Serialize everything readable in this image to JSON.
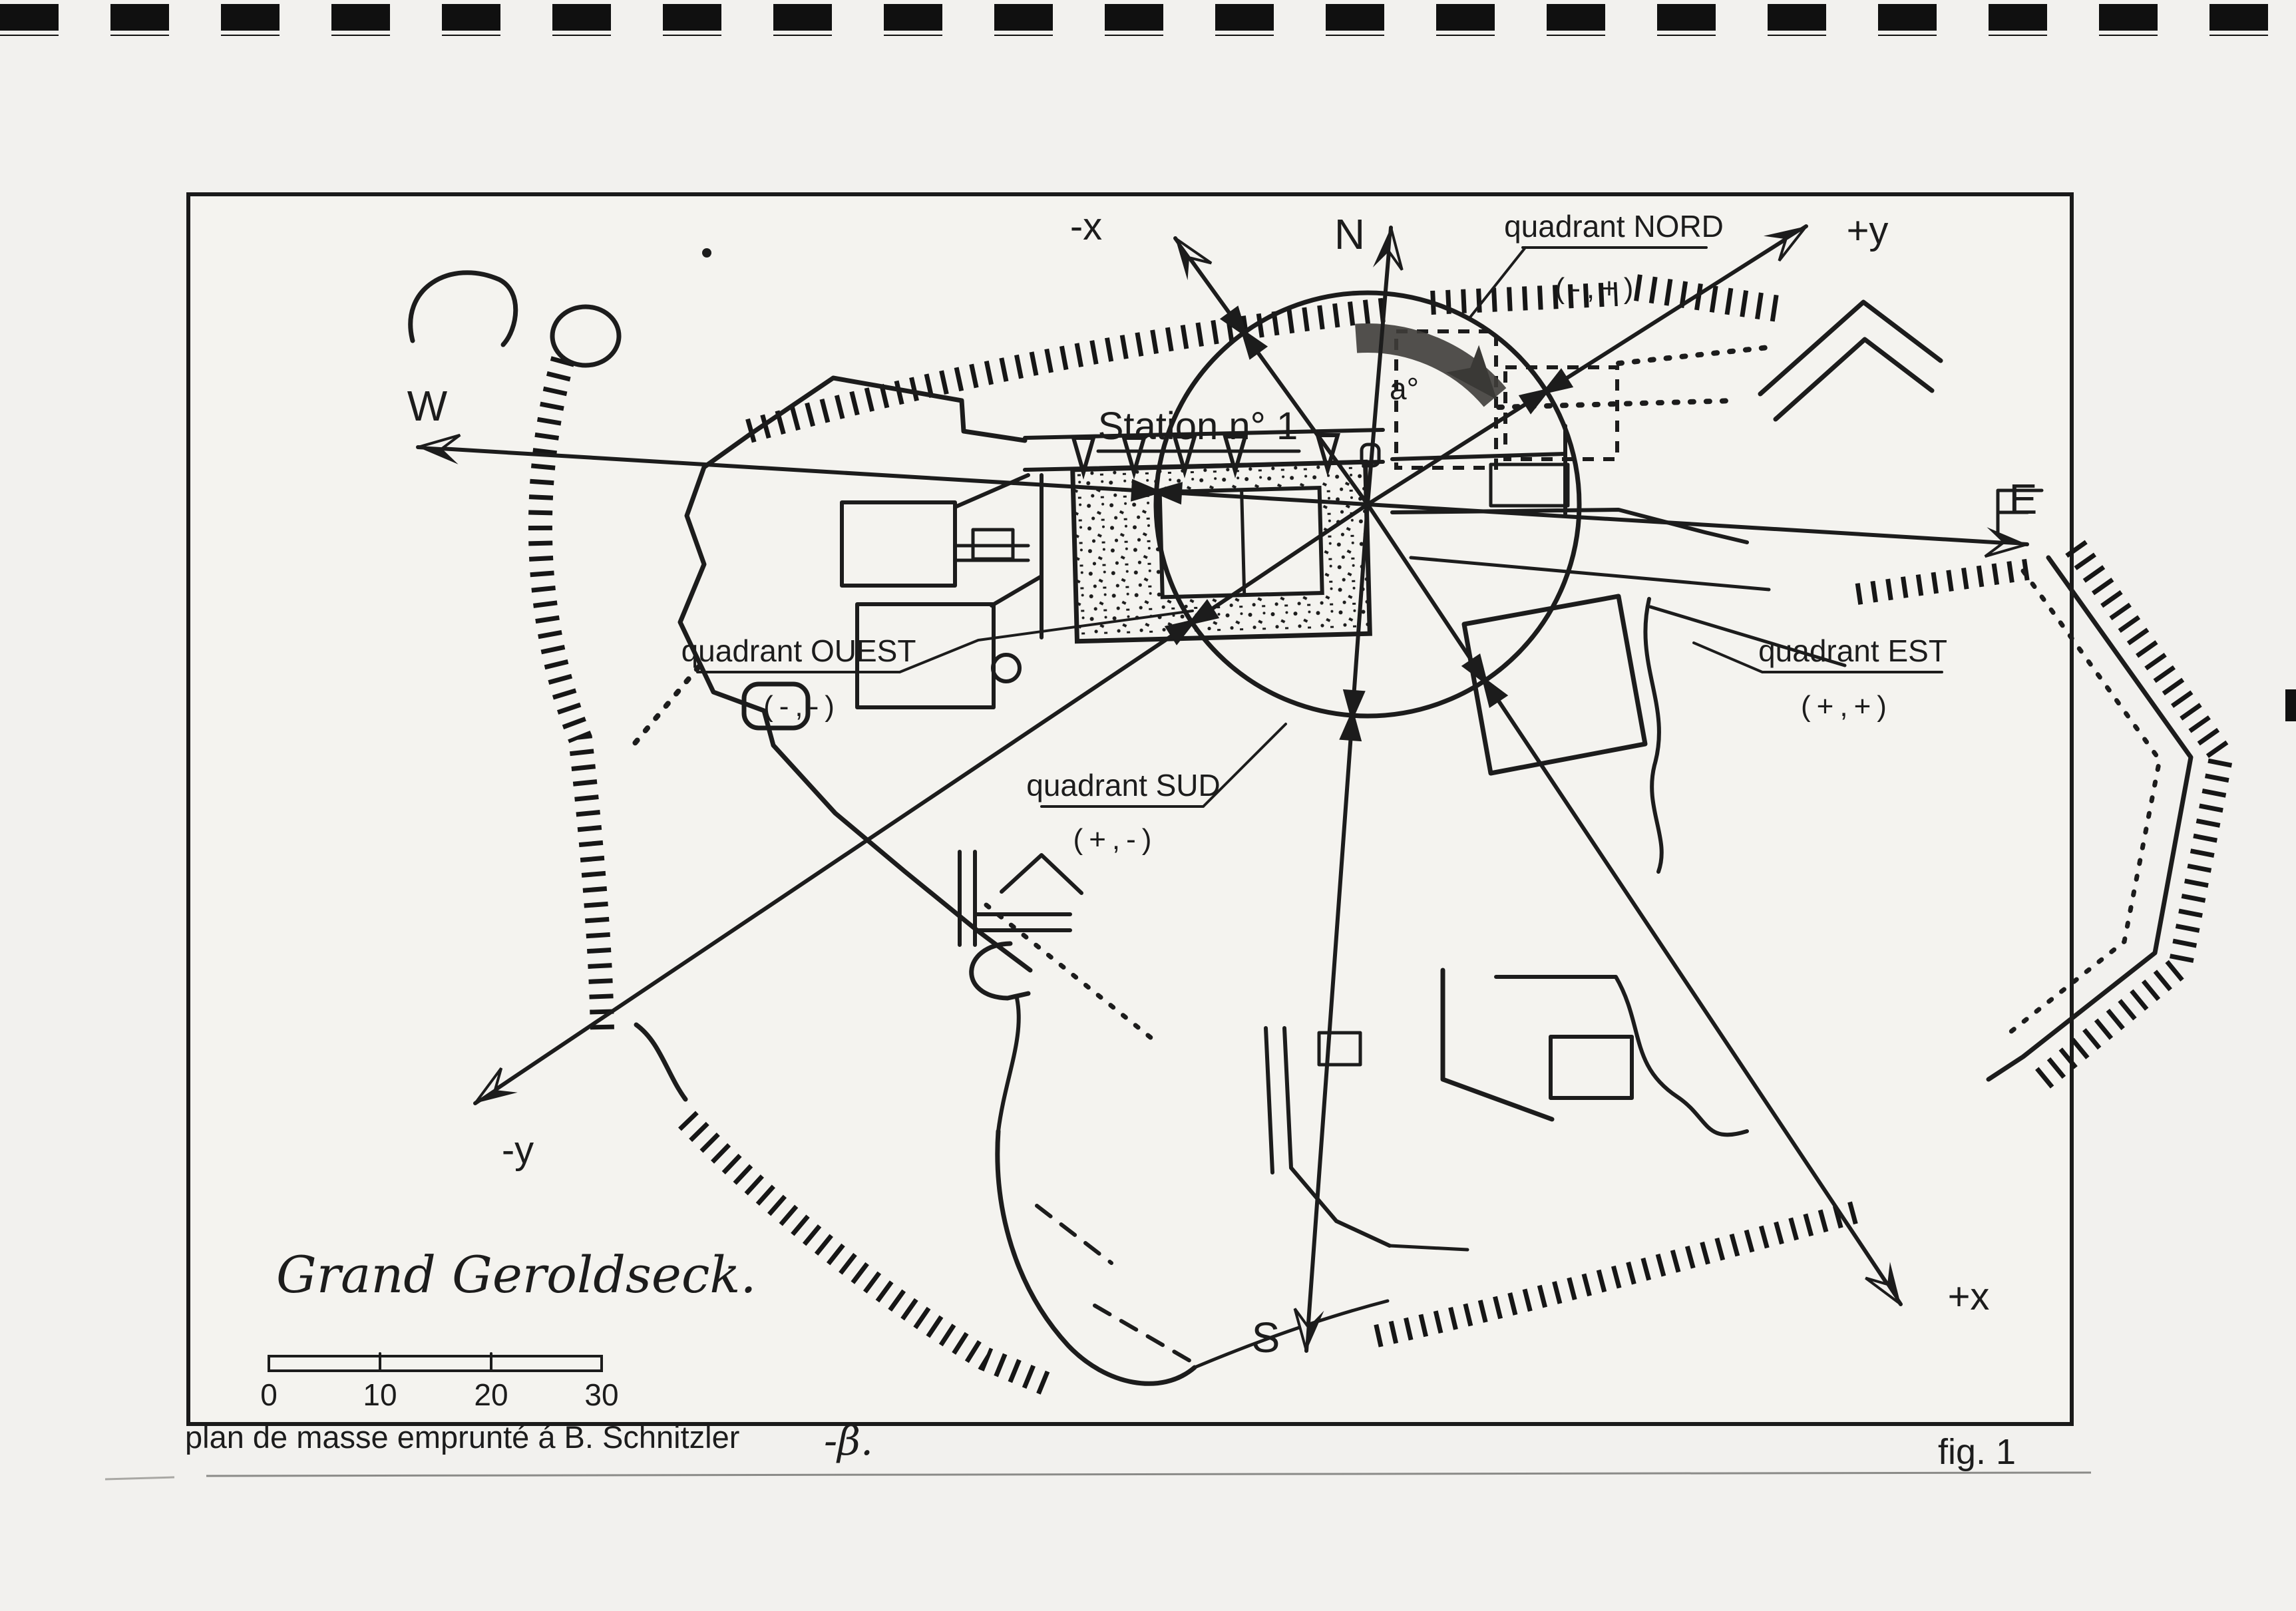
{
  "figure": {
    "fig_label": "fig. 1",
    "caption": "plan de masse emprunté á B. Schnitzler",
    "signature": "-β.",
    "title": "Grand Geroldseck.",
    "station_label": "Station n° 1",
    "angle_label": "a°"
  },
  "axes": {
    "north": "N",
    "south": "S",
    "east": "E",
    "west": "W",
    "minus_x": "-x",
    "plus_x": "+x",
    "minus_y": "-y",
    "plus_y": "+y"
  },
  "quadrants": {
    "nord": {
      "label": "quadrant NORD",
      "sign": "(-,+)"
    },
    "est": {
      "label": "quadrant EST",
      "sign": "(+,+)"
    },
    "sud": {
      "label": "quadrant SUD",
      "sign": "(+,-)"
    },
    "ouest": {
      "label": "quadrant OUEST",
      "sign": "(-,-)"
    }
  },
  "scale_bar": {
    "ticks": [
      "0",
      "10",
      "20",
      "30"
    ]
  },
  "colors": {
    "ink": "#1c1c1c",
    "paper": "#f2f1ee",
    "arc": "#403e3a"
  }
}
